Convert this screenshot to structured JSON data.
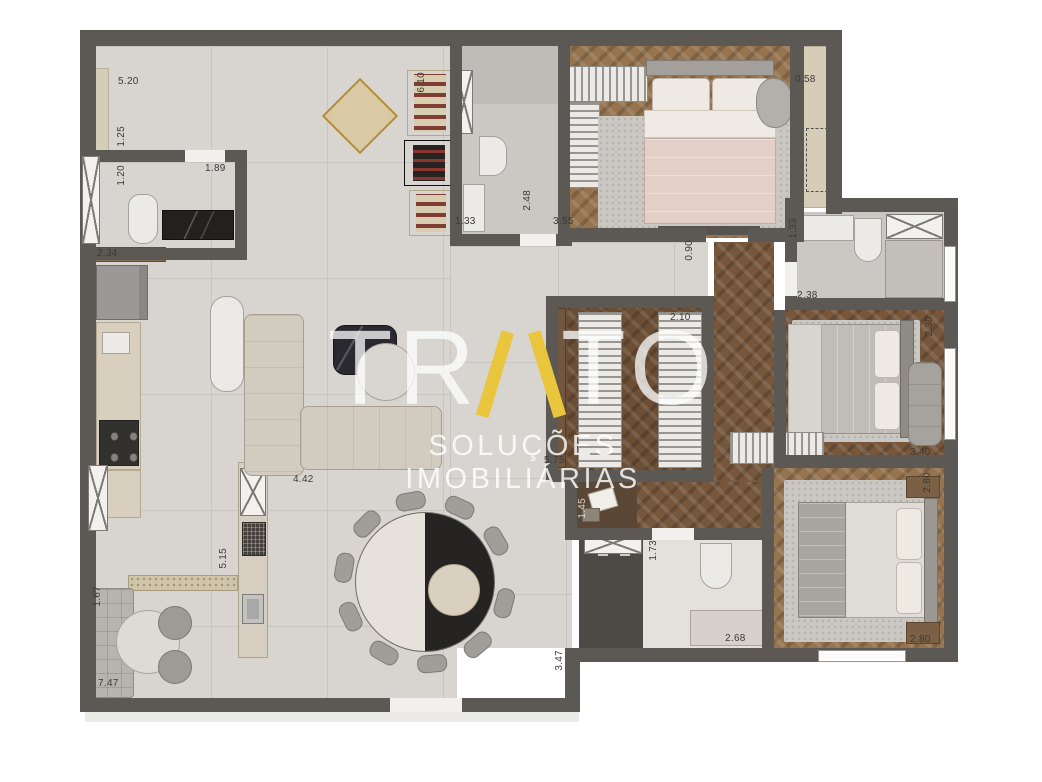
{
  "watermark": {
    "brand_name": "TRATO",
    "brand_left": "TR",
    "brand_accent_letter": "A",
    "brand_right": "TO",
    "subtitle": "SOLUÇÕES IMOBILIÁRIAS",
    "accent_color": "#e9c63d",
    "text_color": "#ffffff"
  },
  "dims": {
    "d01": "5.20",
    "d02": "1.25",
    "d03": "1.20",
    "d04": "1.89",
    "d05": "2.34",
    "d06": "6.10",
    "d07": "1.33",
    "d08": "2.48",
    "d09": "3.55",
    "d10": "0.58",
    "d11": "0.90",
    "d12": "2.10",
    "d13": "2.38",
    "d14": "1.33",
    "d15": "2.30",
    "d16": "3.40",
    "d17": "2.80",
    "d18": "2.80",
    "d19": "1.73",
    "d20": "2.68",
    "d21": "3.47",
    "d22": "5.75",
    "d23": "1.45",
    "d24": "4.42",
    "d25": "5.15",
    "d26": "1.67",
    "d27": "7.47"
  },
  "colors": {
    "wall": "#5c5955",
    "tile_floor": "#d8d5d1",
    "wood_floor": "#77573c",
    "wood_floor_light": "#96744f",
    "accent_gold": "#e9c63d",
    "background": "#ffffff"
  }
}
